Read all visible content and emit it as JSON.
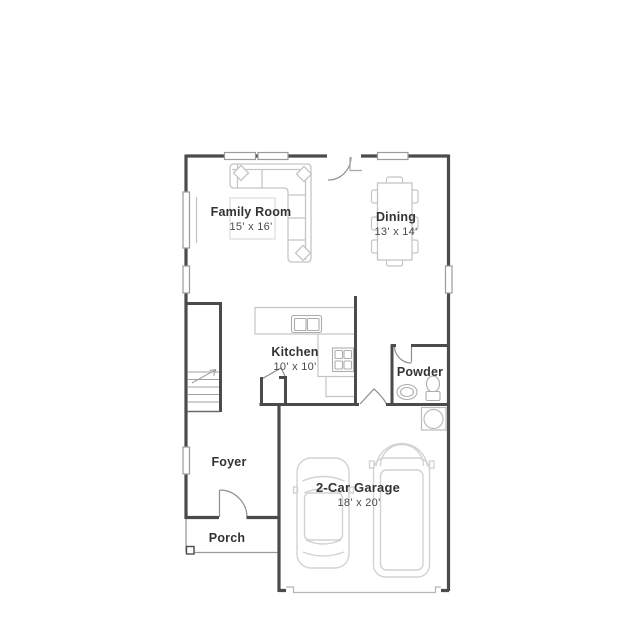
{
  "floor_plan": {
    "rooms": [
      {
        "id": "family-room",
        "name": "Family Room",
        "dims": "15' x 16'"
      },
      {
        "id": "dining",
        "name": "Dining",
        "dims": "13' x 14'"
      },
      {
        "id": "kitchen",
        "name": "Kitchen",
        "dims": "10' x 10'"
      },
      {
        "id": "powder",
        "name": "Powder"
      },
      {
        "id": "foyer",
        "name": "Foyer"
      },
      {
        "id": "porch",
        "name": "Porch"
      },
      {
        "id": "garage",
        "name": "2-Car Garage",
        "dims": "18' x 20'"
      }
    ],
    "fixtures": [
      "sectional-sofa",
      "area-rug",
      "dining-table",
      "dining-chairs",
      "kitchen-counter",
      "kitchen-sink",
      "range-stove",
      "pantry",
      "staircase",
      "stair-direction-arrow",
      "powder-sink",
      "toilet",
      "water-heater",
      "sedan-car",
      "suv-car",
      "garage-door-recess",
      "windows",
      "door-swings",
      "porch-post"
    ],
    "colors": {
      "walls": "#4b4b4b",
      "furniture": "#c5c5c5",
      "fixtures": "#adadad",
      "doors": "#8f8f8f",
      "window_border": "#9b9b9b",
      "text": "#333333",
      "dims_text": "#4a4a4a",
      "background": "#ffffff"
    }
  }
}
